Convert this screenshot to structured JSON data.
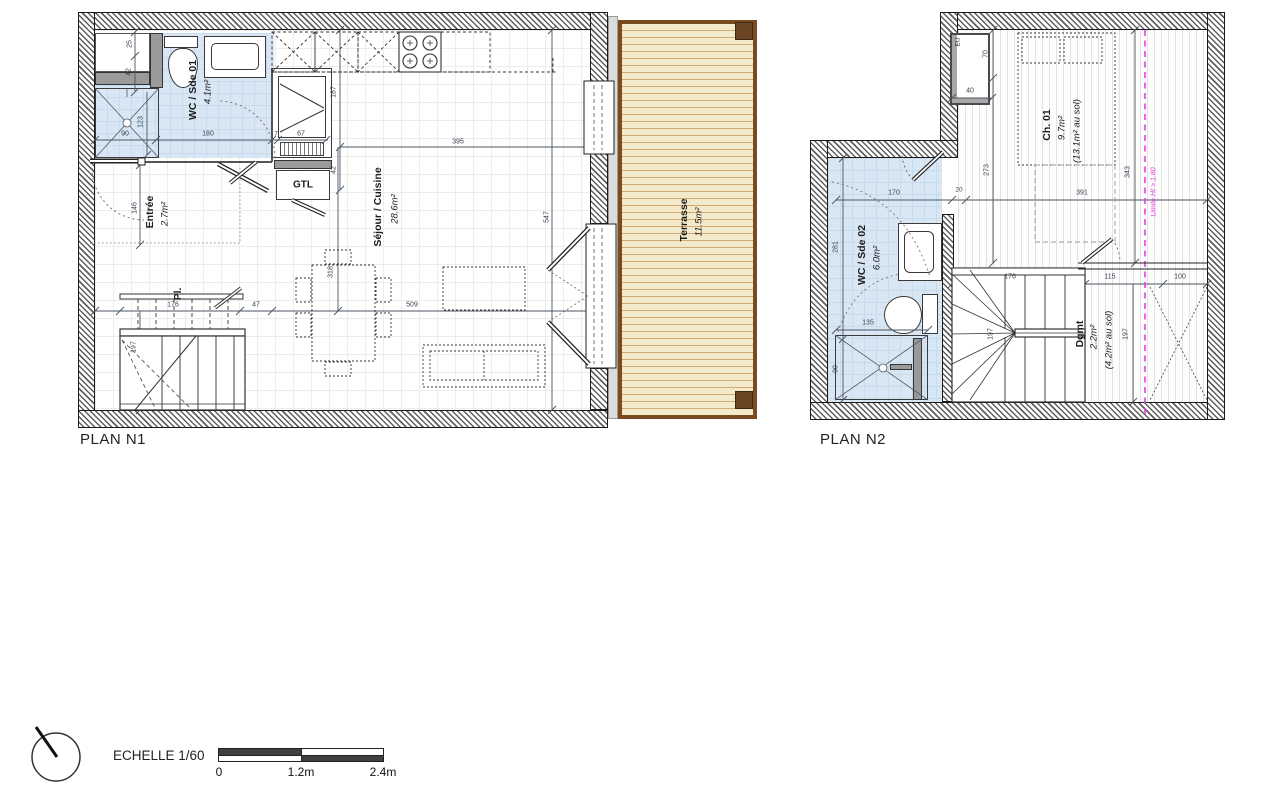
{
  "plan1": {
    "title": "PLAN N1",
    "rooms": {
      "wc": {
        "name": "WC / Sde 01",
        "area": "4.1m²"
      },
      "entree": {
        "name": "Entrée",
        "area": "2.7m²"
      },
      "placard": {
        "name": "Pl."
      },
      "sejour": {
        "name": "Séjour / Cuisine",
        "area": "28.6m²"
      },
      "terrasse": {
        "name": "Terrasse",
        "area": "11.5m²"
      }
    },
    "gtl_label": "GTL",
    "dims": {
      "d25": "25",
      "d42_top": "42",
      "d123": "123",
      "d90": "90",
      "d180": "180",
      "d7": "7",
      "d67": "67",
      "d187": "187",
      "d395": "395",
      "d42_gtl": "42",
      "d146": "146",
      "d176": "176",
      "d47": "47",
      "d509": "509",
      "d197": "197",
      "d318": "318",
      "d547": "547"
    }
  },
  "plan2": {
    "title": "PLAN N2",
    "rooms": {
      "ch": {
        "name": "Ch. 01",
        "area": "9.7m²",
        "area_floor": "(13.1m² au sol)"
      },
      "wc": {
        "name": "WC / Sde 02",
        "area": "6.0m²"
      },
      "dgmt": {
        "name": "Dgmt",
        "area": "2.2m²",
        "area_floor": "(4.2m² au sol)"
      }
    },
    "eu_label": "EU",
    "limite_label": "Limite Ht > 1.80",
    "dims": {
      "d70": "70",
      "d40": "40",
      "d273": "273",
      "d20": "20",
      "d170": "170",
      "d391": "391",
      "d343": "343",
      "d281": "281",
      "d135": "135",
      "d90": "90",
      "d176": "176",
      "d197_stairs": "197",
      "d115": "115",
      "d100": "100",
      "d197_dgmt": "197"
    }
  },
  "legend": {
    "scale_label": "ECHELLE 1/60",
    "ticks": [
      "0",
      "1.2m",
      "2.4m"
    ]
  },
  "colors": {
    "bath_blue": "#d9e7f4",
    "terrace_fill": "#f3e9cb",
    "terrace_frame": "#7a4a21",
    "magenta": "#e83ce8"
  }
}
